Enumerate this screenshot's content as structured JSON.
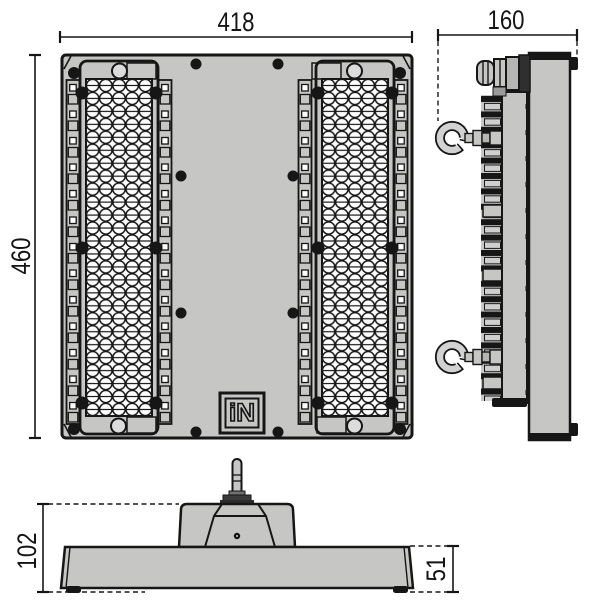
{
  "drawing": {
    "type": "luminaire-technical-dimension-drawing",
    "background": "#ffffff",
    "line_color": "#161616",
    "body_color": "#c6c7c5",
    "logo_text": "iN",
    "dimensions": {
      "front_width": "418",
      "front_height": "460",
      "side_depth": "160",
      "profile_height": "102",
      "profile_base_height": "51"
    }
  }
}
